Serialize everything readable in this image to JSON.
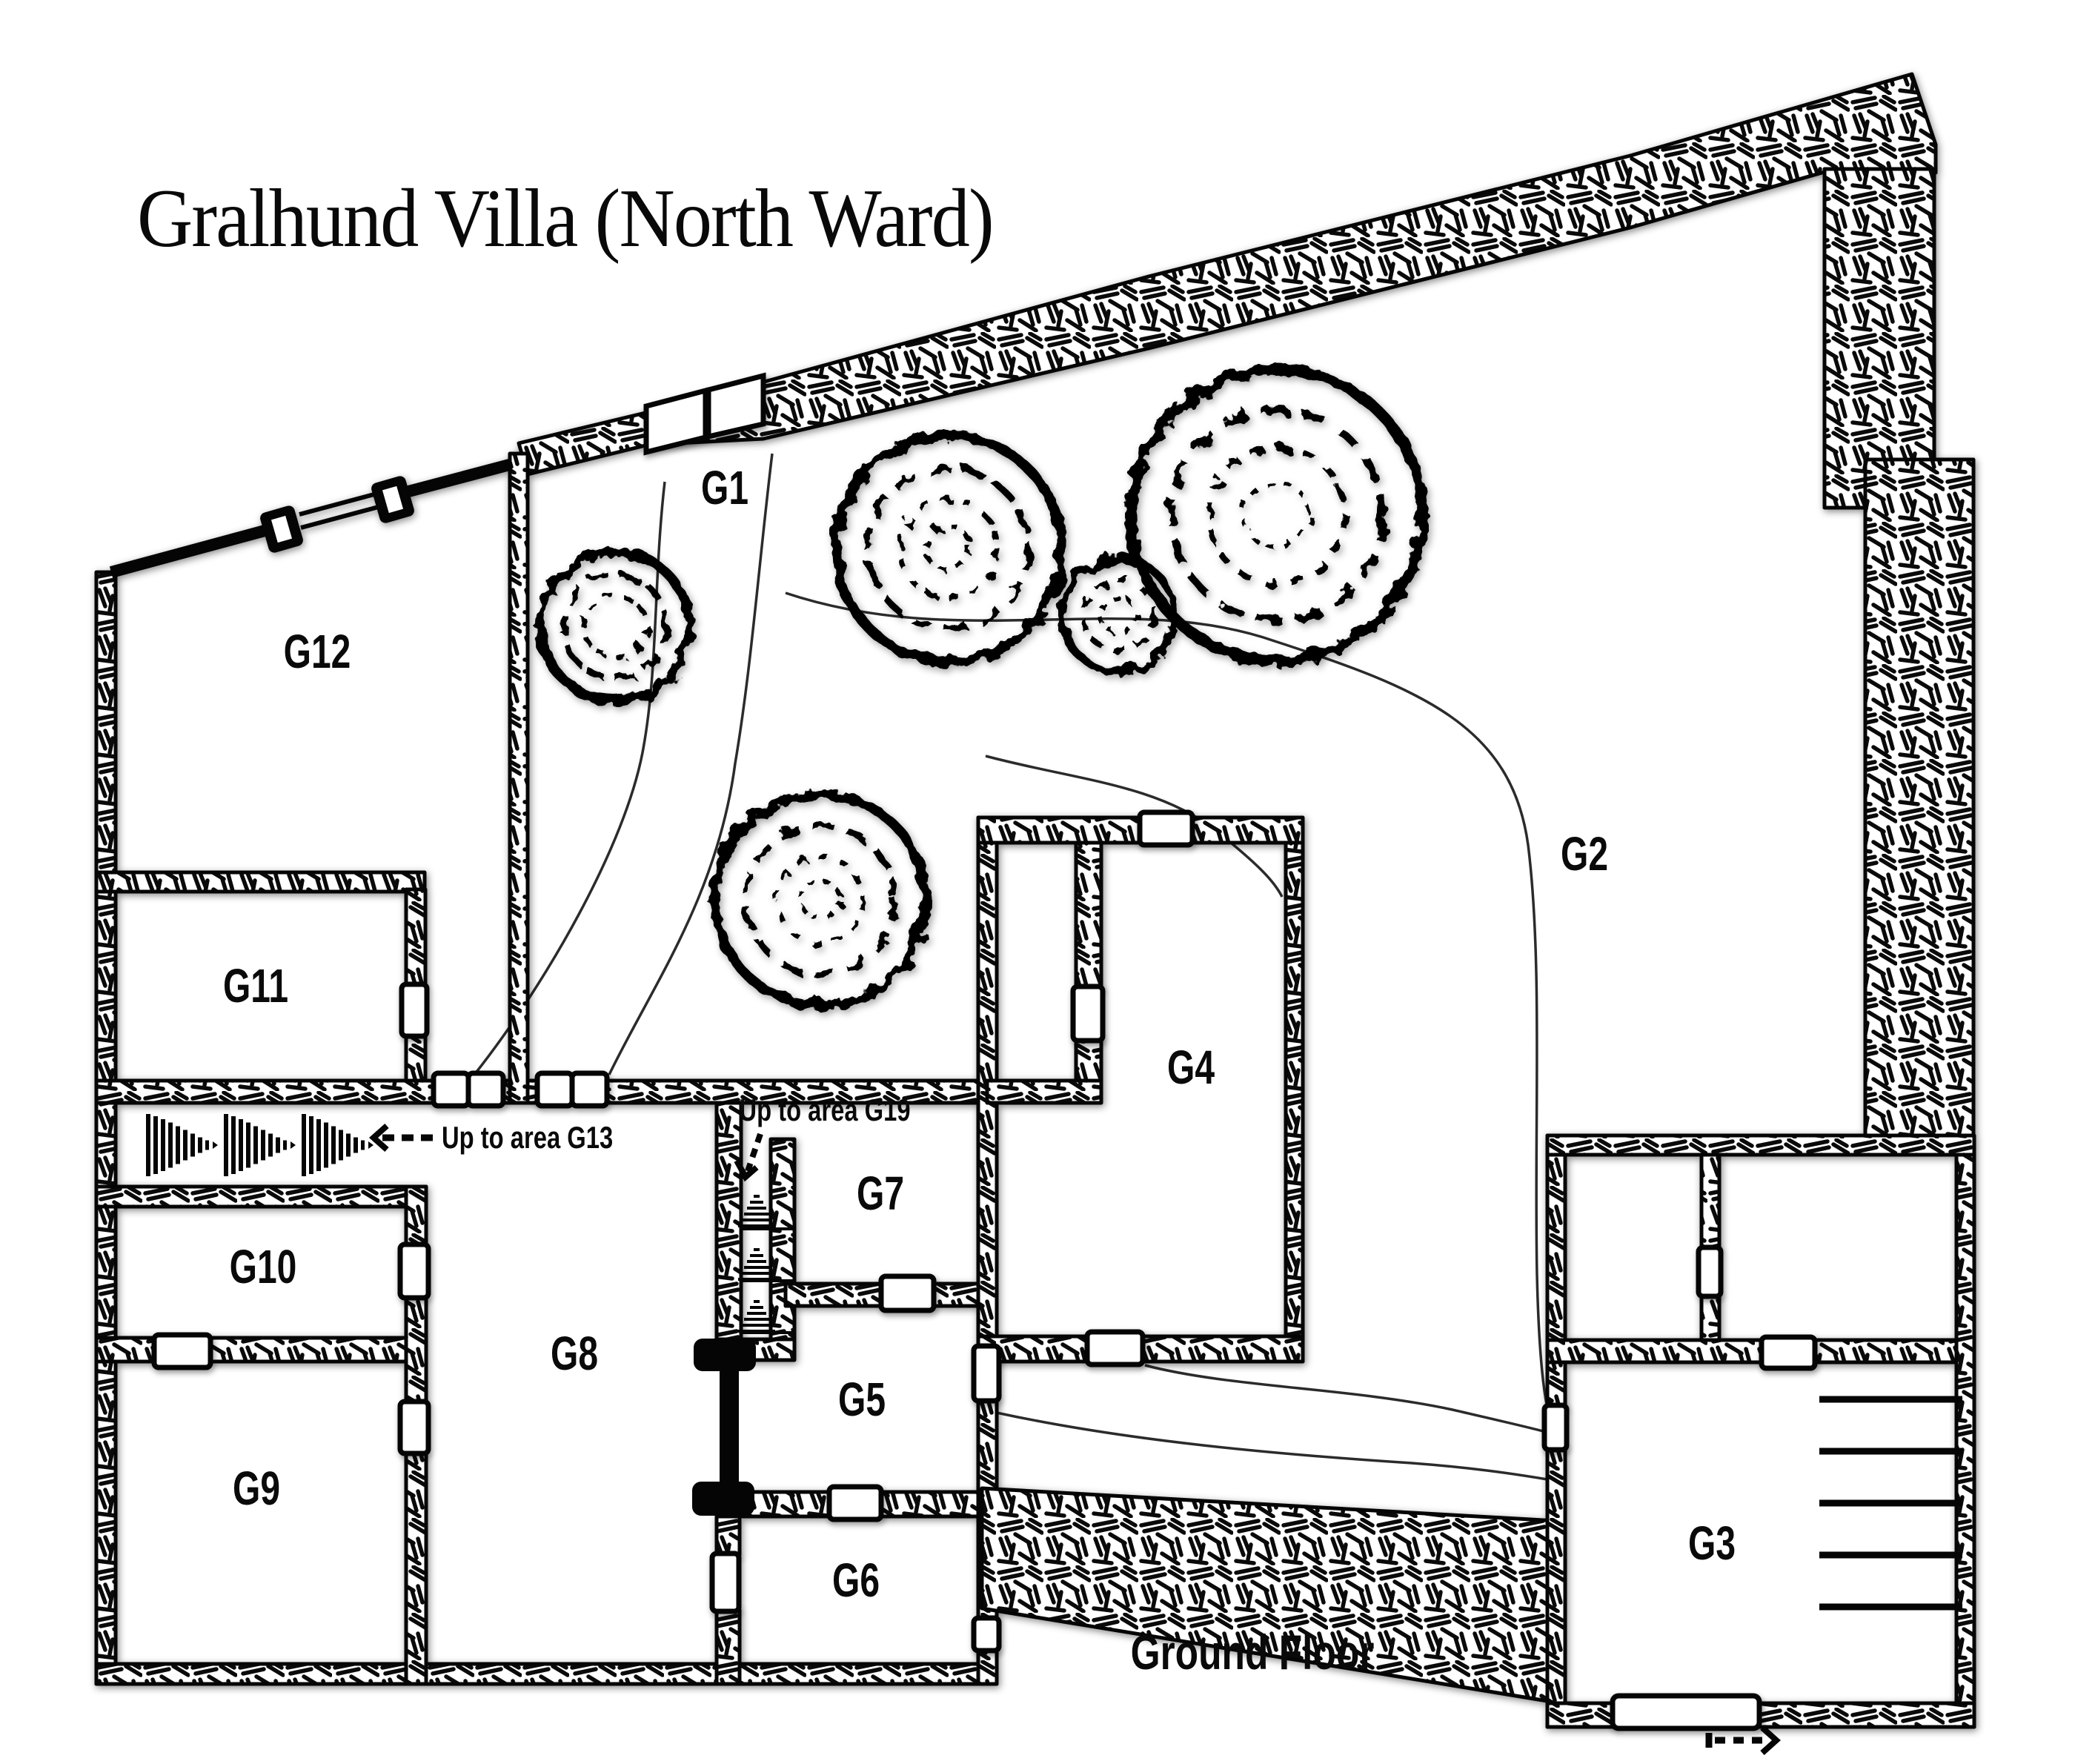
{
  "title": "Gralhund Villa (North Ward)",
  "floor_caption": "Ground Floor",
  "rooms": {
    "g1": "G1",
    "g2": "G2",
    "g3": "G3",
    "g4": "G4",
    "g5": "G5",
    "g6": "G6",
    "g7": "G7",
    "g8": "G8",
    "g9": "G9",
    "g10": "G10",
    "g11": "G11",
    "g12": "G12"
  },
  "annotations": {
    "up_g13": "Up to area G13",
    "up_g19": "Up to area G19"
  },
  "colors": {
    "ink": "#050505",
    "paper": "#ffffff"
  }
}
